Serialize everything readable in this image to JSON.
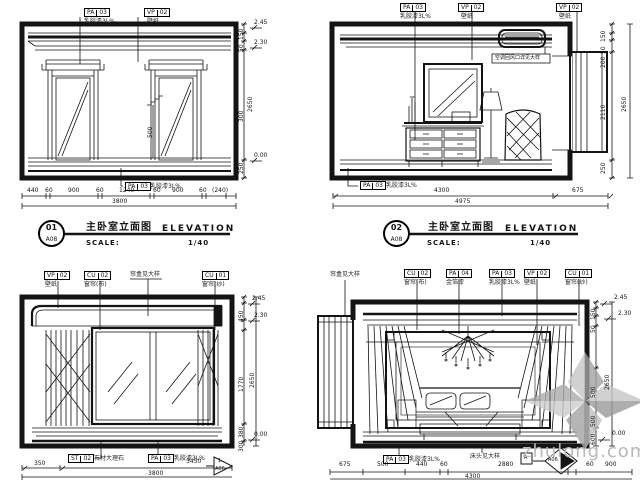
{
  "watermark": {
    "site": "zhulong.com"
  },
  "labels": {
    "elevation": "ELEVATION",
    "scale_label": "SCALE:",
    "scale_value": "1/40"
  },
  "views": {
    "v1": {
      "title_cn": "主卧室立面图",
      "num": "01",
      "sheet": "A08",
      "tags": [
        {
          "sys": "PA",
          "num": "03",
          "note": "乳胶漆3L%"
        },
        {
          "sys": "VP",
          "num": "02",
          "note": "壁纸"
        }
      ],
      "tag_bottom": {
        "sys": "PA",
        "num": "03",
        "note": "乳胶漆3L%"
      },
      "levels": [
        "2.45",
        "2.30",
        "0.00"
      ],
      "vdims": [
        "150",
        "50",
        "2650",
        "300",
        "250"
      ],
      "mid_dim": "500",
      "hdims": [
        "440",
        "60",
        "900",
        "60",
        "1240",
        "60",
        "900",
        "60",
        "(240)"
      ],
      "htotal": "3800"
    },
    "v2": {
      "title_cn": "主卧室立面图",
      "num": "02",
      "sheet": "A08",
      "tags": [
        {
          "sys": "PA",
          "num": "03",
          "note": "乳胶漆3L%"
        },
        {
          "sys": "VP",
          "num": "02",
          "note": "壁纸"
        },
        {
          "sys": "VP",
          "num": "02",
          "note": "壁纸"
        }
      ],
      "tag_bottom": {
        "sys": "PA",
        "num": "03",
        "note": "乳胶漆3L%"
      },
      "ac_note": "空调回风口详见大样",
      "vdims": [
        "150",
        "50",
        "200",
        "2110",
        "2650",
        "250"
      ],
      "hdims": [
        "4300",
        "675"
      ],
      "htotal": "4975"
    },
    "v3": {
      "tags": [
        {
          "sys": "VP",
          "num": "02",
          "note": "壁纸"
        },
        {
          "sys": "CU",
          "num": "02",
          "note": "窗帘(布)"
        },
        {
          "sys": "CU",
          "num": "01",
          "note": "窗帘(纱)"
        }
      ],
      "top_note": "帘盒见大样",
      "tags_bottom": [
        {
          "sys": "ST",
          "num": "02",
          "note": "石材大理石"
        },
        {
          "sys": "PA",
          "num": "03",
          "note": "乳胶漆3L%"
        }
      ],
      "levels": [
        "2.45",
        "2.30",
        "0.00"
      ],
      "vdims": [
        "450",
        "1770",
        "380",
        "2650",
        "300"
      ],
      "hdims": [
        "350",
        "3450"
      ],
      "htotal": "3800",
      "marker": {
        "num": "1",
        "sheet": "A06"
      }
    },
    "v4": {
      "left_note": "帘盒见大样",
      "tags": [
        {
          "sys": "CU",
          "num": "02",
          "note": "窗帘(布)"
        },
        {
          "sys": "PA",
          "num": "04",
          "note": "金箔漆"
        },
        {
          "sys": "PA",
          "num": "03",
          "note": "乳胶漆3L%"
        },
        {
          "sys": "VP",
          "num": "02",
          "note": "壁纸"
        },
        {
          "sys": "CU",
          "num": "01",
          "note": "窗帘(纱)"
        }
      ],
      "tag_bottom": {
        "sys": "PA",
        "num": "03",
        "note": "乳胶漆3L%"
      },
      "bottom_note": "床头见大样",
      "levels": [
        "2.45",
        "2.30",
        "0.00"
      ],
      "vdims": [
        "150",
        "50",
        "500",
        "2650",
        "500",
        "600"
      ],
      "hdims": [
        "675",
        "500",
        "440",
        "60",
        "2880",
        "60",
        "900"
      ],
      "htotal": "4300",
      "marker": {
        "num": "A",
        "sheet": "A06"
      }
    }
  }
}
